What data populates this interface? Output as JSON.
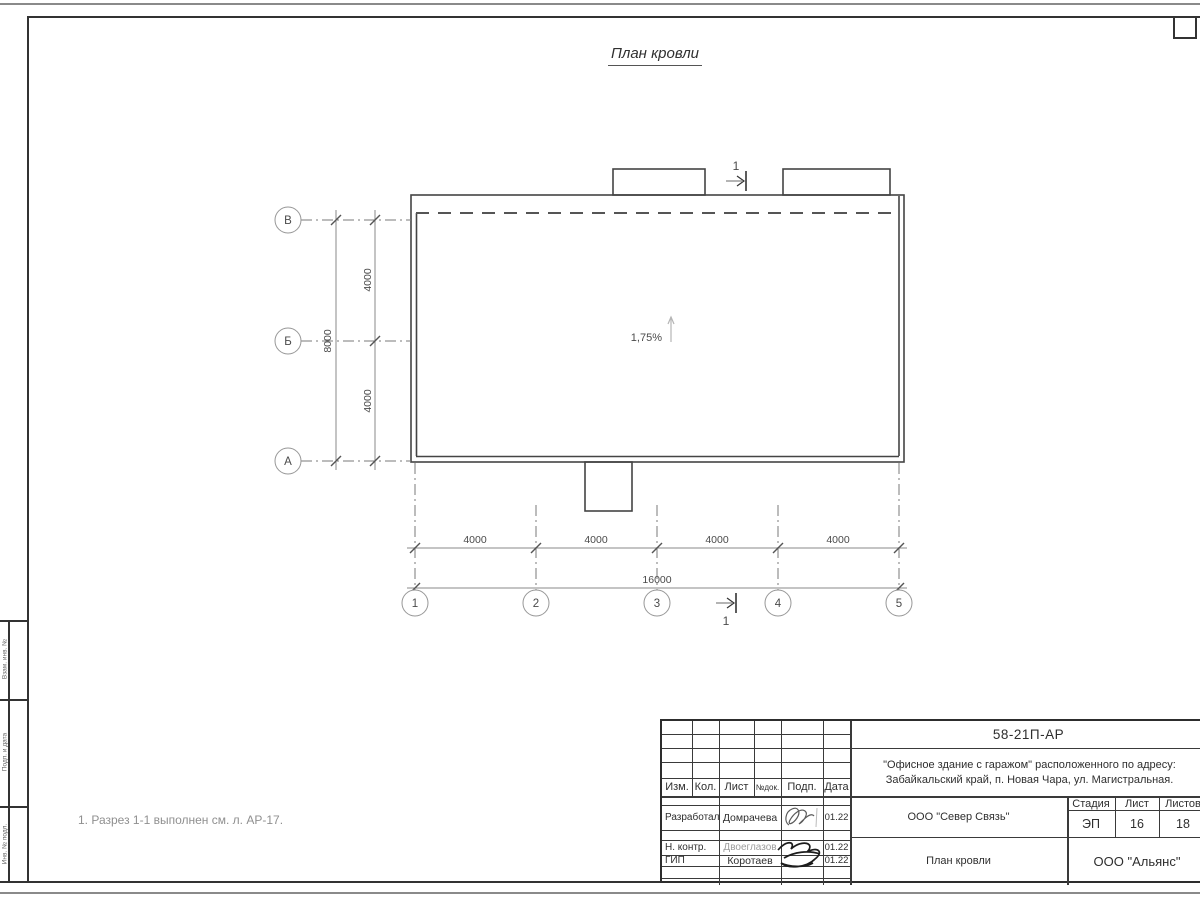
{
  "title": "План кровли",
  "note": "1. Разрез 1-1 выполнен см. л. АР-17.",
  "plan": {
    "slope_label": "1,75%",
    "section_label": "1",
    "axes_vertical": [
      "В",
      "Б",
      "А"
    ],
    "axes_horizontal": [
      "1",
      "2",
      "3",
      "4",
      "5"
    ],
    "dims": {
      "vert_total": "8000",
      "vert_parts": [
        "4000",
        "4000"
      ],
      "horiz_parts": [
        "4000",
        "4000",
        "4000",
        "4000"
      ],
      "horiz_total": "16000"
    }
  },
  "side_stamp": {
    "labels": [
      "Взам. инв. №",
      "Подп. и дата",
      "Инв. № подл."
    ]
  },
  "title_block": {
    "doc_number": "58-21П-АР",
    "project_line1": "\"Офисное здание с гаражом\" расположенного по адресу:",
    "project_line2": "Забайкальский край, п. Новая Чара, ул. Магистральная.",
    "rev_headers": [
      "Изм.",
      "Кол.",
      "Лист",
      "№док.",
      "Подп.",
      "Дата"
    ],
    "staff": [
      {
        "role": "Разработал",
        "name": "Домрачева",
        "date": "01.22"
      },
      {
        "role": "Н. контр.",
        "name": "Двоеглазов",
        "date": "01.22"
      },
      {
        "role": "ГИП",
        "name": "Коротаев",
        "date": "01.22"
      }
    ],
    "org1": "ООО \"Север Связь\"",
    "org2": "ООО \"Альянс\"",
    "stage_headers": [
      "Стадия",
      "Лист",
      "Листов"
    ],
    "stage": "ЭП",
    "sheet": "16",
    "sheets_total": "18",
    "drawing_name": "План кровли"
  }
}
